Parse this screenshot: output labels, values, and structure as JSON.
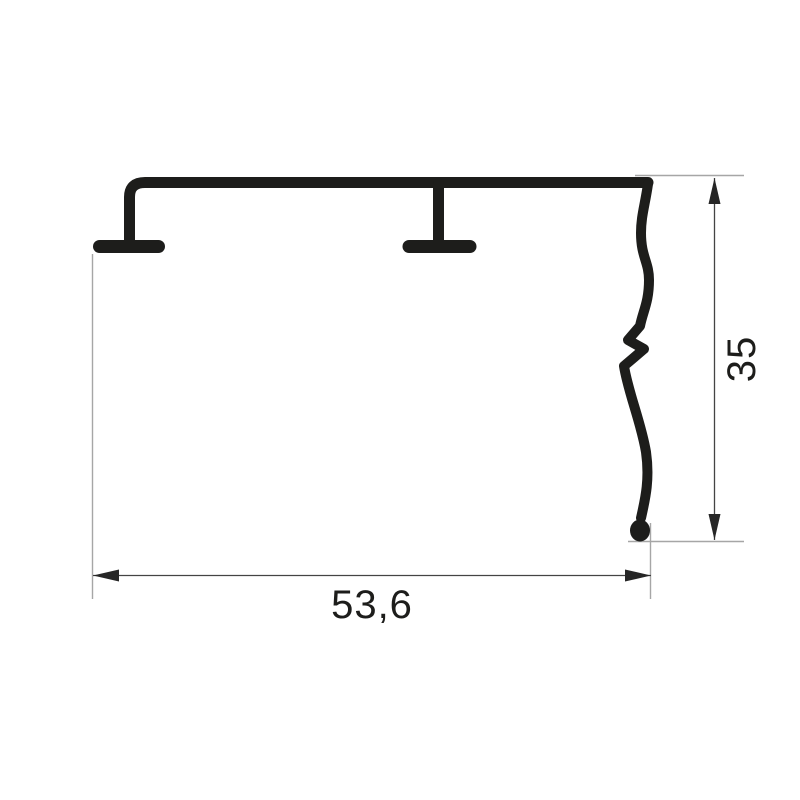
{
  "drawing": {
    "background_color": "#ffffff",
    "profile_color": "#1d1d1b",
    "dimension_line_color": "#444444",
    "extension_line_color": "#a6a6a6",
    "label_color": "#1d1d1b"
  },
  "dimensions": {
    "width": {
      "label": "53,6"
    },
    "height": {
      "label": "35"
    }
  }
}
